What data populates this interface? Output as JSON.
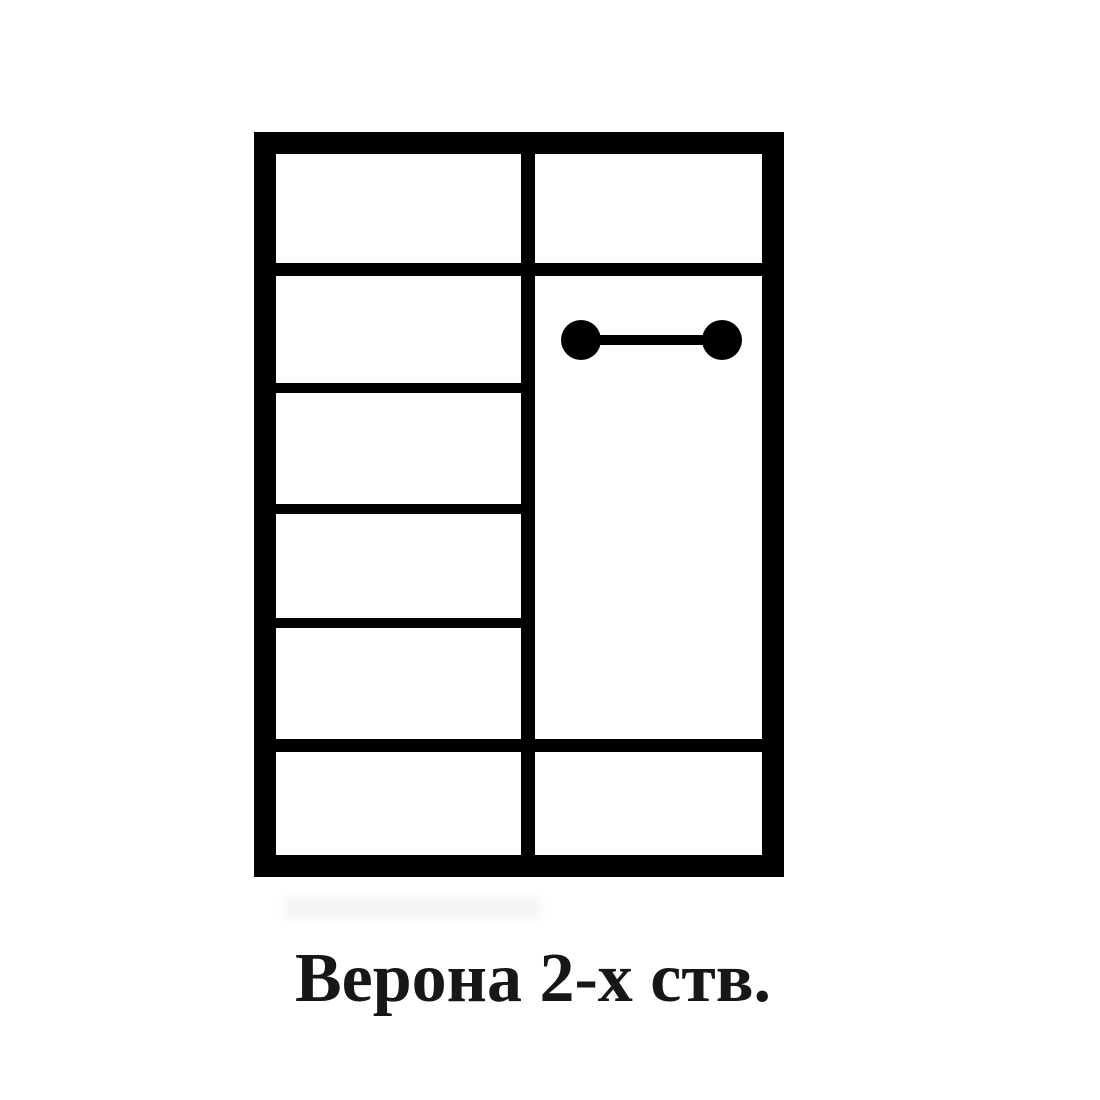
{
  "page": {
    "background": "#ffffff",
    "width": 1100,
    "height": 1100
  },
  "caption": {
    "text": "Верона 2-х ств.",
    "color": "#171717"
  },
  "diagram": {
    "type": "wardrobe-front-scheme",
    "description": "Two-door wardrobe internal layout: left section with shelf stack, right section with hanger rod, shared top and bottom compartments",
    "line_color": "#000000",
    "frame": {
      "x": 254,
      "y": 132,
      "width": 530,
      "height": 745,
      "border": 22
    },
    "divider": {
      "x": 521,
      "width": 14
    },
    "full_width_shelves_y": [
      263,
      739
    ],
    "full_width_shelf_thickness": 13,
    "left_section_shelves_y": [
      383,
      504,
      618
    ],
    "left_section_shelf_thickness": 10,
    "left_section_compartments": 6,
    "hanger_rod": {
      "x1": 581,
      "x2": 722,
      "y": 340,
      "end_radius": 20,
      "bar_thickness": 10
    }
  }
}
